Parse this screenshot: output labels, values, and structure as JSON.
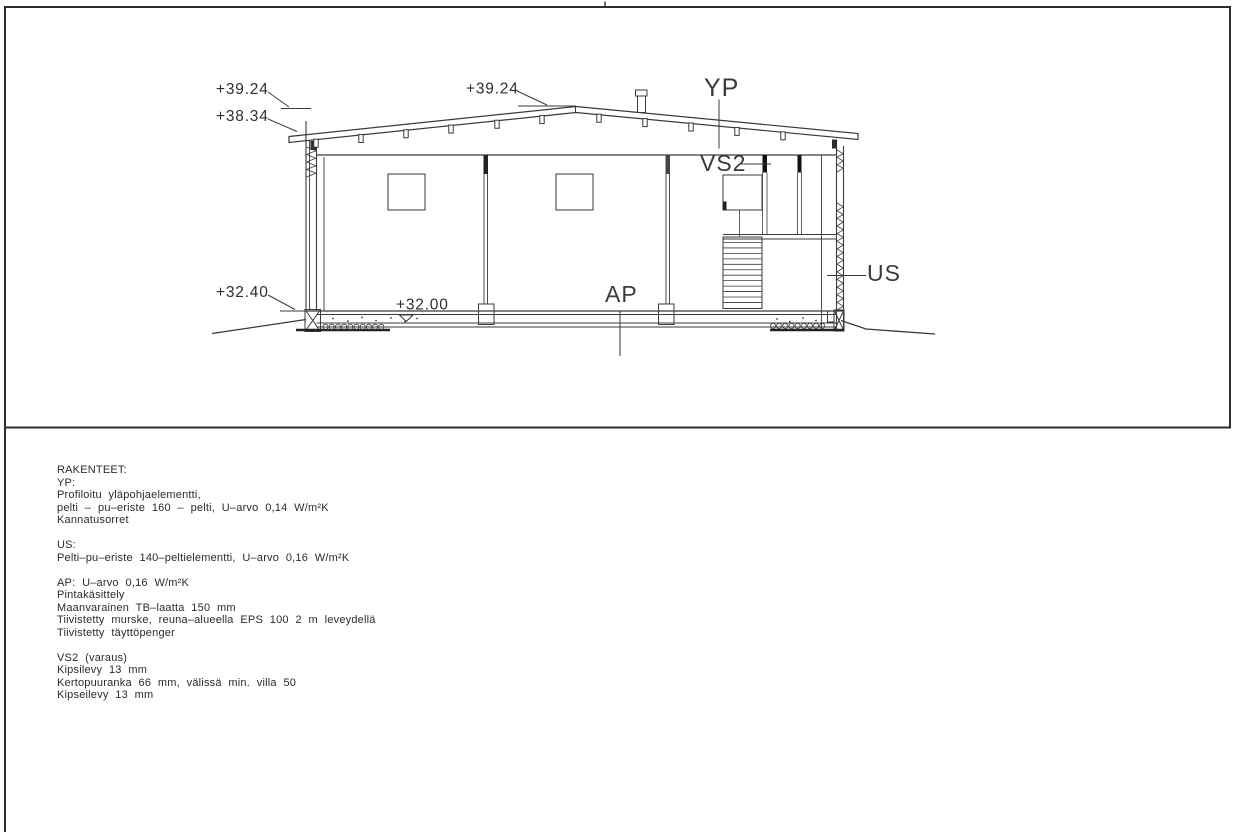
{
  "drawing": {
    "levels": {
      "ridge_left": "+39.24",
      "eave_left": "+38.34",
      "ridge_mid": "+39.24",
      "ground_left": "+32.40",
      "floor": "+32.00"
    },
    "labels": {
      "roof": "YP",
      "partition": "VS2",
      "exterior_wall": "US",
      "floor_slab": "AP"
    }
  },
  "notes": {
    "title": "RAKENTEET:",
    "sections": [
      {
        "lines": [
          "YP:",
          "Profiloitu yläpohjaelementti,",
          "pelti – pu–eriste 160 – pelti, U–arvo 0,14 W/m²K",
          "Kannatusorret"
        ]
      },
      {
        "lines": [
          "US:",
          "Pelti–pu–eriste 140–peltielementti, U–arvo 0,16 W/m²K"
        ]
      },
      {
        "lines": [
          "AP: U–arvo 0,16 W/m²K",
          "Pintakäsittely",
          "Maanvarainen TB–laatta 150 mm",
          "Tiivistetty murske, reuna–alueella EPS 100 2 m leveydellä",
          "Tiivistetty täyttöpenger"
        ]
      },
      {
        "lines": [
          "VS2 (varaus)",
          "Kipsilevy 13 mm",
          "Kertopuuranka 66 mm, välissä min. villa 50",
          "Kipseilevy 13 mm"
        ]
      }
    ]
  },
  "colors": {
    "line": "#3a3a3a",
    "frame": "#2d2d2d",
    "text": "#2b2b2b"
  }
}
